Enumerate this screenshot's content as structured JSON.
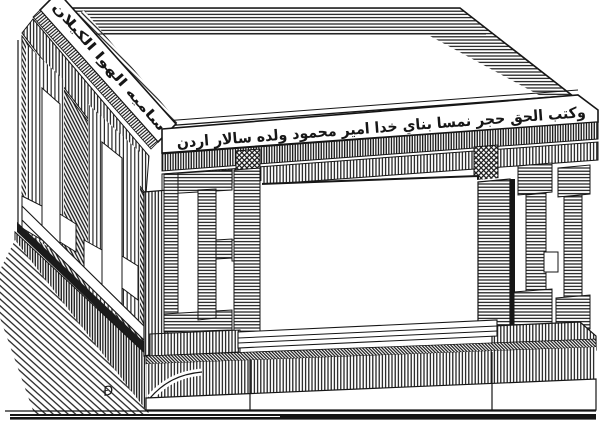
{
  "figure": {
    "paper_color": "#ffffff",
    "ink_color": "#161616",
    "inscriptions": {
      "front_band": "وكتب الحق حجر نمسا بناي خدا امير محمود ولده سالار اردن",
      "left_band": "ساميه الهوا الكيلان"
    },
    "engraver_mark": "Ɖ"
  }
}
